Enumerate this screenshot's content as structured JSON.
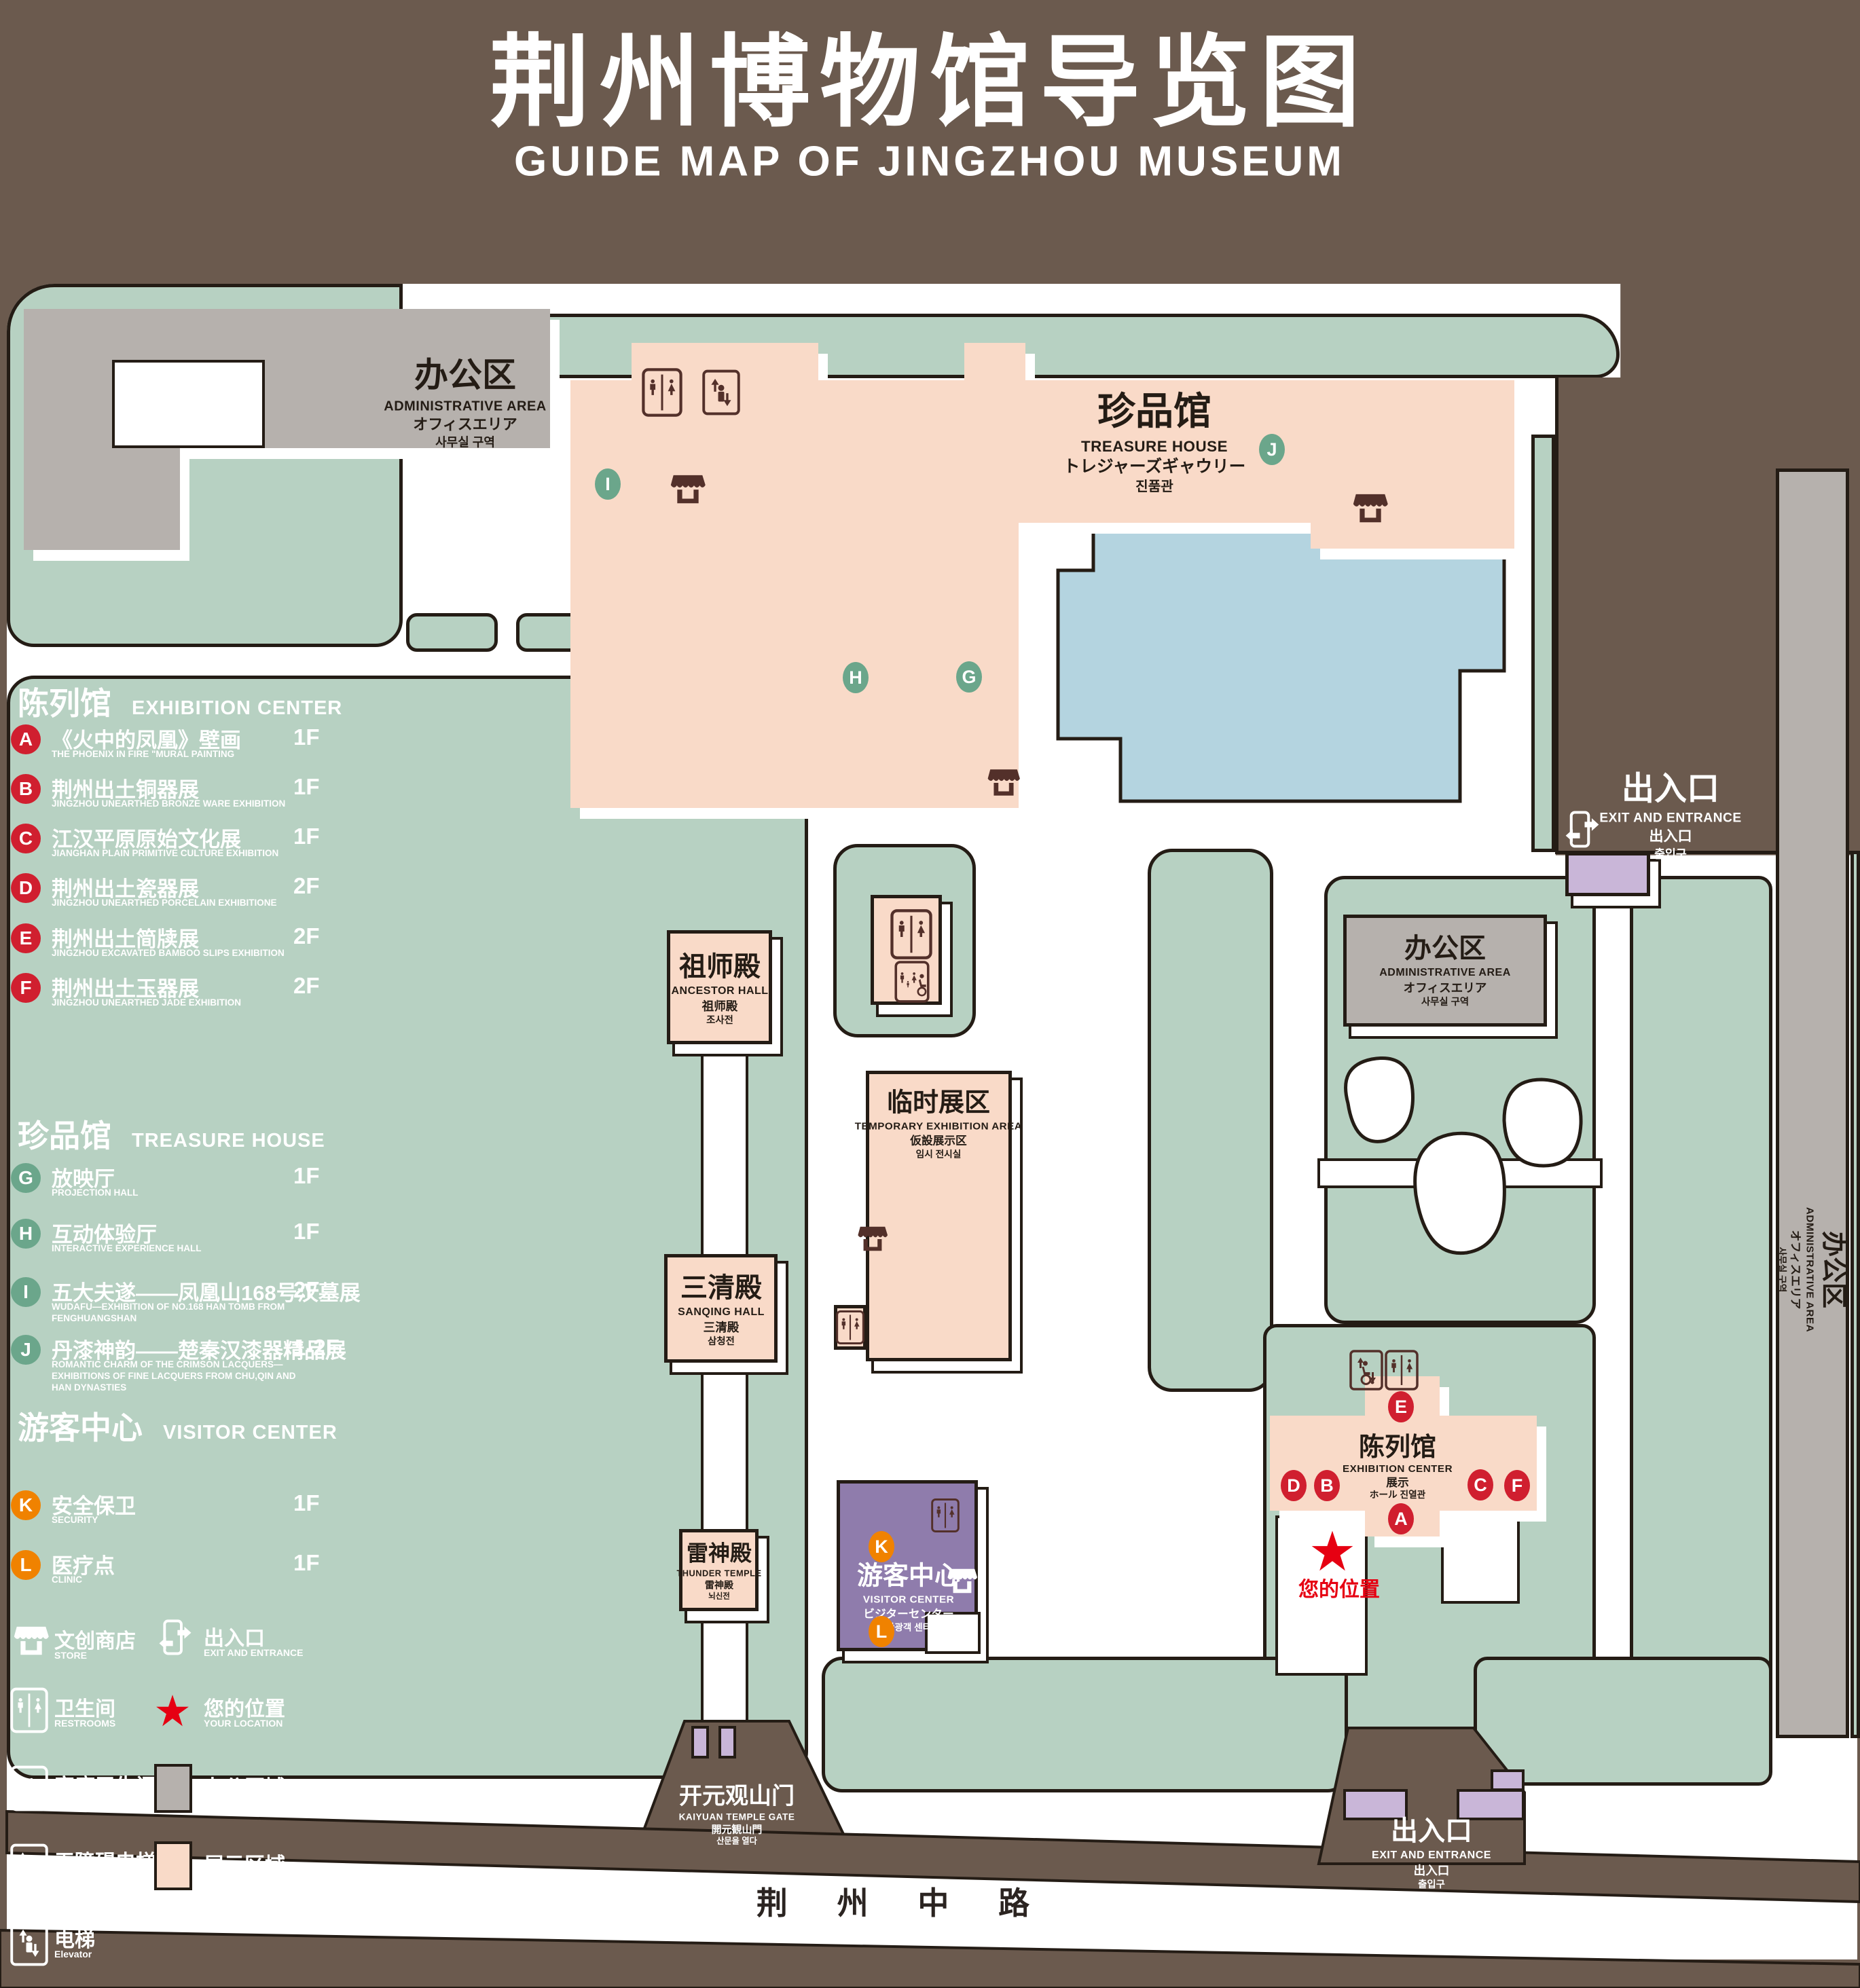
{
  "title": {
    "zh": "荆州博物馆导览图",
    "en": "GUIDE MAP OF JINGZHOU MUSEUM"
  },
  "colors": {
    "background": "#6b5a4e",
    "green_area": "#b7d1c2",
    "display_area": "#f9dac8",
    "office_area": "#b6b1ad",
    "pond": "#b4d4e0",
    "purple_building": "#c9b6d8",
    "visitor_center": "#8f7cac",
    "red_marker": "#d01f2f",
    "green_marker": "#6ba68b",
    "orange_marker": "#f08200",
    "icon_brown": "#53302a",
    "star_red": "#e60012"
  },
  "legend": {
    "sections": [
      {
        "zh": "陈列馆",
        "en": "EXHIBITION CENTER",
        "marker_color": "#d01f2f",
        "items": [
          {
            "letter": "A",
            "zh": "《火中的凤凰》壁画",
            "en": "THE PHOENIX IN FIRE \"MURAL PAINTING",
            "floor": "1F"
          },
          {
            "letter": "B",
            "zh": "荆州出土铜器展",
            "en": "JINGZHOU UNEARTHED BRONZE WARE EXHIBITION",
            "floor": "1F"
          },
          {
            "letter": "C",
            "zh": "江汉平原原始文化展",
            "en": "JIANGHAN PLAIN PRIMITIVE CULTURE EXHIBITION",
            "floor": "1F"
          },
          {
            "letter": "D",
            "zh": "荆州出土瓷器展",
            "en": "JINGZHOU UNEARTHED PORCELAIN EXHIBITIONE",
            "floor": "2F"
          },
          {
            "letter": "E",
            "zh": "荆州出土简牍展",
            "en": "JINGZHOU EXCAVATED BAMBOO SLIPS EXHIBITION",
            "floor": "2F"
          },
          {
            "letter": "F",
            "zh": "荆州出土玉器展",
            "en": "JINGZHOU UNEARTHED JADE EXHIBITION",
            "floor": "2F"
          }
        ]
      },
      {
        "zh": "珍品馆",
        "en": "TREASURE HOUSE",
        "marker_color": "#6ba68b",
        "items": [
          {
            "letter": "G",
            "zh": "放映厅",
            "en": "PROJECTION HALL",
            "floor": "1F"
          },
          {
            "letter": "H",
            "zh": "互动体验厅",
            "en": "INTERACTIVE EXPERIENCE HALL",
            "floor": "1F"
          },
          {
            "letter": "I",
            "zh": "五大夫遂——凤凰山168号汉墓展",
            "en": "WUDAFU—EXHIBITION OF NO.168 HAN TOMB FROM FENGHUANGSHAN",
            "floor": "2F"
          },
          {
            "letter": "J",
            "zh": "丹漆神韵——楚秦汉漆器精品展",
            "en": "ROMANTIC CHARM OF THE CRIMSON LACQUERS—EXHIBITIONS OF FINE LACQUERS FROM CHU,QIN AND HAN DYNASTIES",
            "floor": "1-2F"
          }
        ]
      },
      {
        "zh": "游客中心",
        "en": "VISITOR CENTER",
        "marker_color": "#f08200",
        "items": [
          {
            "letter": "K",
            "zh": "安全保卫",
            "en": "SECURITY",
            "floor": "1F"
          },
          {
            "letter": "L",
            "zh": "医疗点",
            "en": "CLINIC",
            "floor": "1F"
          }
        ]
      }
    ],
    "symbols": [
      {
        "icon": "store-icon",
        "zh": "文创商店",
        "en": "STORE"
      },
      {
        "icon": "exit-icon",
        "zh": "出入口",
        "en": "EXIT AND ENTRANCE"
      },
      {
        "icon": "restrooms-icon",
        "zh": "卫生间",
        "en": "RESTROOMS"
      },
      {
        "icon": "your-location-star-icon",
        "zh": "您的位置",
        "en": "YOUR LOCATION"
      },
      {
        "icon": "family-restrooms-icon",
        "zh": "家庭卫生间",
        "en": "FAMILY RESTROOMS"
      },
      {
        "icon": "office-area-swatch",
        "zh": "办公区域",
        "en": "OFFICE AREA",
        "swatch": "#b6b1ad"
      },
      {
        "icon": "accessible-elevator-icon",
        "zh": "无障碍电梯",
        "en": "ACCESSIBLE ELEVATOR"
      },
      {
        "icon": "display-area-swatch",
        "zh": "展示区域",
        "en": "DISPLAY AREA",
        "swatch": "#f9dac8"
      },
      {
        "icon": "elevator-icon",
        "zh": "电梯",
        "en": "Elevator"
      }
    ]
  },
  "map": {
    "buildings": {
      "admin": {
        "zh": "办公区",
        "en": "ADMINISTRATIVE AREA",
        "ja": "オフィスエリア",
        "ko": "사무실 구역"
      },
      "treasure": {
        "zh": "珍品馆",
        "en": "TREASURE HOUSE",
        "ja": "トレジャーズギャウリー",
        "ko": "진품관"
      },
      "ancestor": {
        "zh": "祖师殿",
        "en": "ANCESTOR HALL",
        "ja": "祖师殿",
        "ko": "조사전"
      },
      "temporary": {
        "zh": "临时展区",
        "en": "TEMPORARY EXHIBITION AREA",
        "ja": "仮設展示区",
        "ko": "임시 전시실"
      },
      "sanqing": {
        "zh": "三清殿",
        "en": "SANQING HALL",
        "ja": "三清殿",
        "ko": "삼청전"
      },
      "thunder": {
        "zh": "雷神殿",
        "en": "THUNDER TEMPLE",
        "ja": "雷神殿",
        "ko": "뇌신전"
      },
      "visitor": {
        "zh": "游客中心",
        "en": "VISITOR CENTER",
        "ja": "ビジターセンター",
        "ko": "관광객 센터"
      },
      "exhibition": {
        "zh": "陈列馆",
        "en": "EXHIBITION CENTER",
        "ja": "展示",
        "ko": "ホール 진열관"
      },
      "gate": {
        "zh": "开元观山门",
        "en": "KAIYUAN TEMPLE GATE",
        "ja": "開元観山門",
        "ko": "산문을 열다"
      }
    },
    "exit": {
      "zh": "出入口",
      "en": "EXIT AND ENTRANCE",
      "ja": "出入口",
      "ko": "출입구"
    },
    "road": "荆 州 中 路",
    "your_location": {
      "zh": "您的位置",
      "en": "YOUR LOCATION"
    },
    "markers": [
      {
        "letter": "I",
        "color": "#6ba68b"
      },
      {
        "letter": "J",
        "color": "#6ba68b"
      },
      {
        "letter": "H",
        "color": "#6ba68b"
      },
      {
        "letter": "G",
        "color": "#6ba68b"
      },
      {
        "letter": "E",
        "color": "#d01f2f"
      },
      {
        "letter": "D",
        "color": "#d01f2f"
      },
      {
        "letter": "B",
        "color": "#d01f2f"
      },
      {
        "letter": "C",
        "color": "#d01f2f"
      },
      {
        "letter": "F",
        "color": "#d01f2f"
      },
      {
        "letter": "A",
        "color": "#d01f2f"
      },
      {
        "letter": "K",
        "color": "#f08200"
      },
      {
        "letter": "L",
        "color": "#f08200"
      }
    ]
  }
}
